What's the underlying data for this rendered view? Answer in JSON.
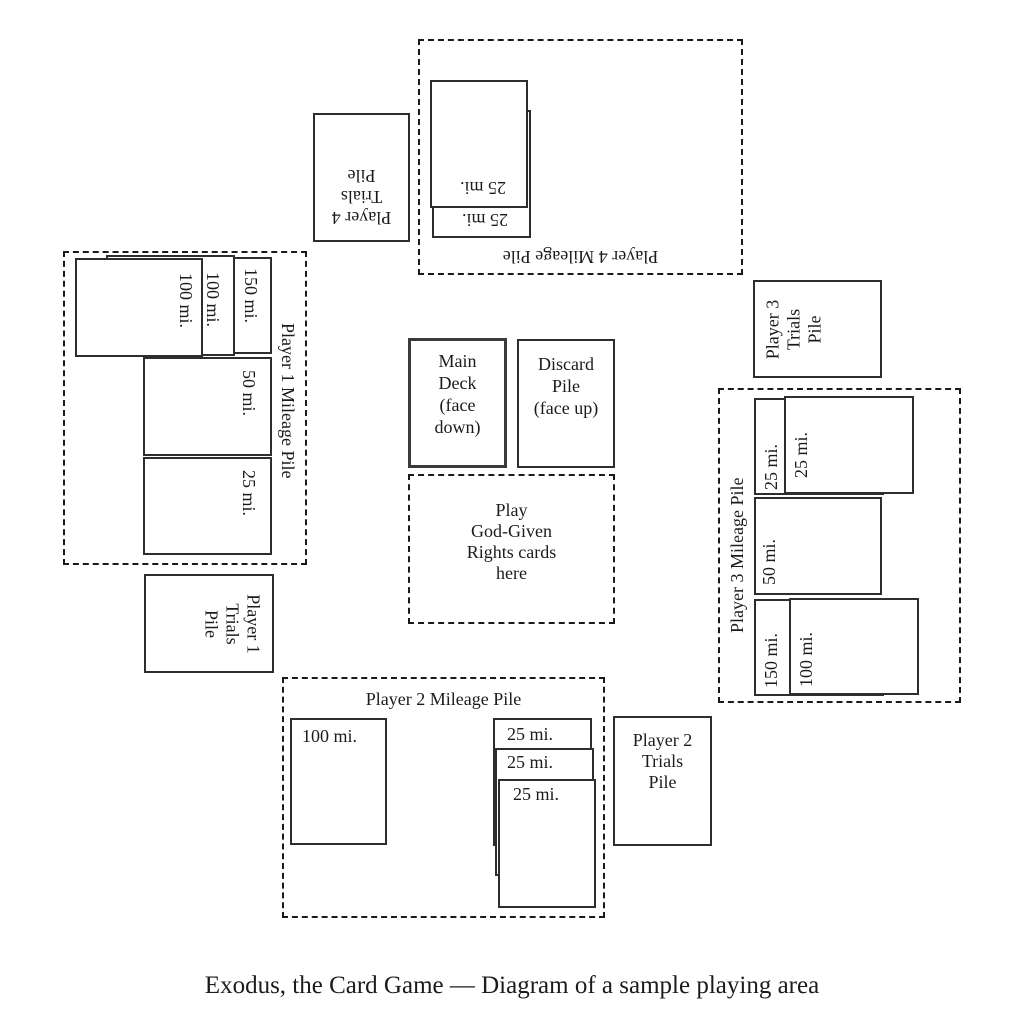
{
  "colors": {
    "ink": "#1b1b1b",
    "card_border": "#2d2d2d",
    "dashed_border": "#1a1a1a",
    "background": "#ffffff"
  },
  "caption": "Exodus, the Card Game — Diagram of a sample playing area",
  "center": {
    "main_deck_lines": [
      "Main",
      "Deck",
      "(face",
      "down)"
    ],
    "discard_lines": [
      "Discard",
      "Pile",
      "(face up)"
    ],
    "play_area_lines": [
      "Play",
      "God-Given",
      "Rights cards",
      "here"
    ]
  },
  "player1": {
    "mileage_title": "Player 1 Mileage Pile",
    "trials_lines": [
      "Player 1",
      "Trials",
      "Pile"
    ],
    "mileage_cards": [
      "150 mi.",
      "100 mi.",
      "100 mi.",
      "50 mi.",
      "25 mi."
    ]
  },
  "player2": {
    "mileage_title": "Player 2 Mileage Pile",
    "trials_lines": [
      "Player 2",
      "Trials",
      "Pile"
    ],
    "mileage_cards": [
      "100 mi.",
      "25 mi.",
      "25 mi.",
      "25 mi."
    ]
  },
  "player3": {
    "mileage_title": "Player 3 Mileage Pile",
    "trials_lines": [
      "Player 3",
      "Trials",
      "Pile"
    ],
    "mileage_cards": [
      "25 mi.",
      "25 mi.",
      "50 mi.",
      "150 mi.",
      "100 mi."
    ]
  },
  "player4": {
    "mileage_title": "Player 4 Mileage Pile",
    "trials_lines": [
      "Player 4",
      "Trials",
      "Pile"
    ],
    "mileage_cards": [
      "25 mi.",
      "25 mi."
    ]
  }
}
